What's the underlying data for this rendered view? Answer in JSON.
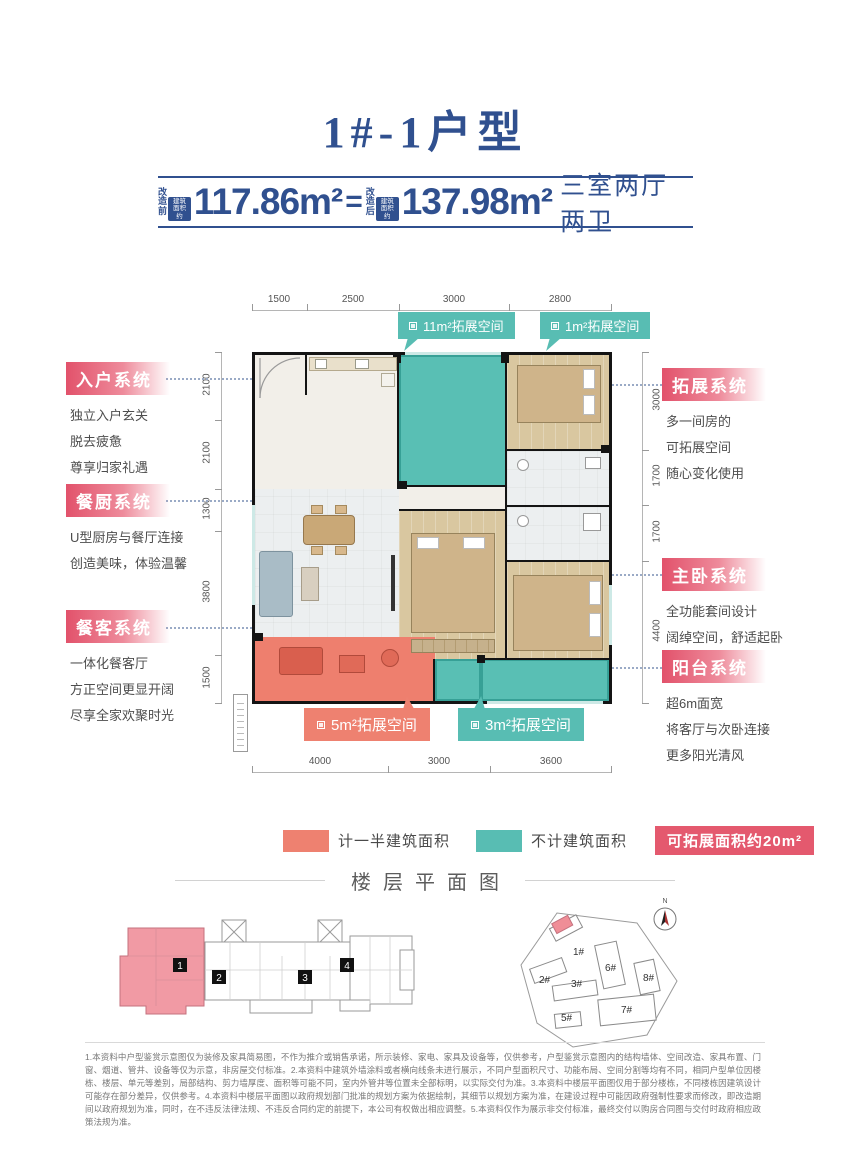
{
  "colors": {
    "navy": "#30508f",
    "teal": "#58bdb3",
    "salmon": "#ee8170",
    "legend_badge": "#e4596e",
    "system_label": "#e2526b"
  },
  "title": "1#-1户型",
  "area_bar": {
    "before_label": "改\n造\n前",
    "before_tag": "建筑面积约",
    "before_value": "117.86m²",
    "equals": "=",
    "after_label": "改\n造\n后",
    "after_tag": "建筑面积约",
    "after_value": "137.98m²",
    "layout": "三室两厅两卫"
  },
  "dims": {
    "top": [
      "1500",
      "2500",
      "3000",
      "2800"
    ],
    "bottom": [
      "4000",
      "3000",
      "3600"
    ],
    "left": [
      "2100",
      "2100",
      "1300",
      "3800",
      "1500"
    ],
    "right": [
      "3000",
      "1700",
      "1700",
      "4400"
    ]
  },
  "callouts": {
    "c11": "11m²拓展空间",
    "c1": "1m²拓展空间",
    "c5": "5m²拓展空间",
    "c3": "3m²拓展空间"
  },
  "systems": {
    "left": [
      {
        "title": "入户系统",
        "lines": [
          "独立入户玄关",
          "脱去疲惫",
          "尊享归家礼遇"
        ]
      },
      {
        "title": "餐厨系统",
        "lines": [
          "U型厨房与餐厅连接",
          "创造美味，体验温馨"
        ]
      },
      {
        "title": "餐客系统",
        "lines": [
          "一体化餐客厅",
          "方正空间更显开阔",
          "尽享全家欢聚时光"
        ]
      }
    ],
    "right": [
      {
        "title": "拓展系统",
        "lines": [
          "多一间房的",
          "可拓展空间",
          "随心变化使用"
        ]
      },
      {
        "title": "主卧系统",
        "lines": [
          "全功能套间设计",
          "阔绰空间，舒适起卧"
        ]
      },
      {
        "title": "阳台系统",
        "lines": [
          "超6m面宽",
          "将客厅与次卧连接",
          "更多阳光清风"
        ]
      }
    ]
  },
  "legend": {
    "half_area": "计一半建筑面积",
    "not_counted": "不计建筑面积",
    "expandable": "可拓展面积约20m²"
  },
  "floorplate": {
    "section_title": "楼层平面图",
    "units": [
      "1",
      "2",
      "3",
      "4"
    ]
  },
  "siteplan": {
    "buildings": [
      "1#",
      "2#",
      "3#",
      "5#",
      "6#",
      "7#",
      "8#"
    ],
    "north": "N"
  },
  "disclaimer": "1.本资料中户型鉴赏示意图仅为装修及家具简易图，不作为推介或销售承诺，所示装修、家电、家具及设备等，仅供参考，户型鉴赏示意图内的结构墙体、空间改造、家具布置、门窗、烟道、管井、设备等仅为示意，非房屋交付标准。2.本资料中建筑外墙涂料或者横向线条未进行展示，不同户型面积尺寸、功能布局、空间分割等均有不同，相同户型单位因楼栋、楼层、单元等差别，局部结构、剪力墙厚度、面积等可能不同，室内外管井等位置未全部标明，以实际交付为准。3.本资料中楼层平面图仅用于部分楼栋，不同楼栋因建筑设计可能存在部分差异，仅供参考。4.本资料中楼层平面图以政府规划部门批准的规划方案为依据绘制，其细节以规划方案为准，在建设过程中可能因政府强制性要求而修改，即改造期间以政府规划为准，同时，在不违反法律法规、不违反合同约定的前提下，本公司有权做出相应调整。5.本资料仅作为展示非交付标准，最终交付以购房合同图与交付时政府相应政策法规为准。"
}
